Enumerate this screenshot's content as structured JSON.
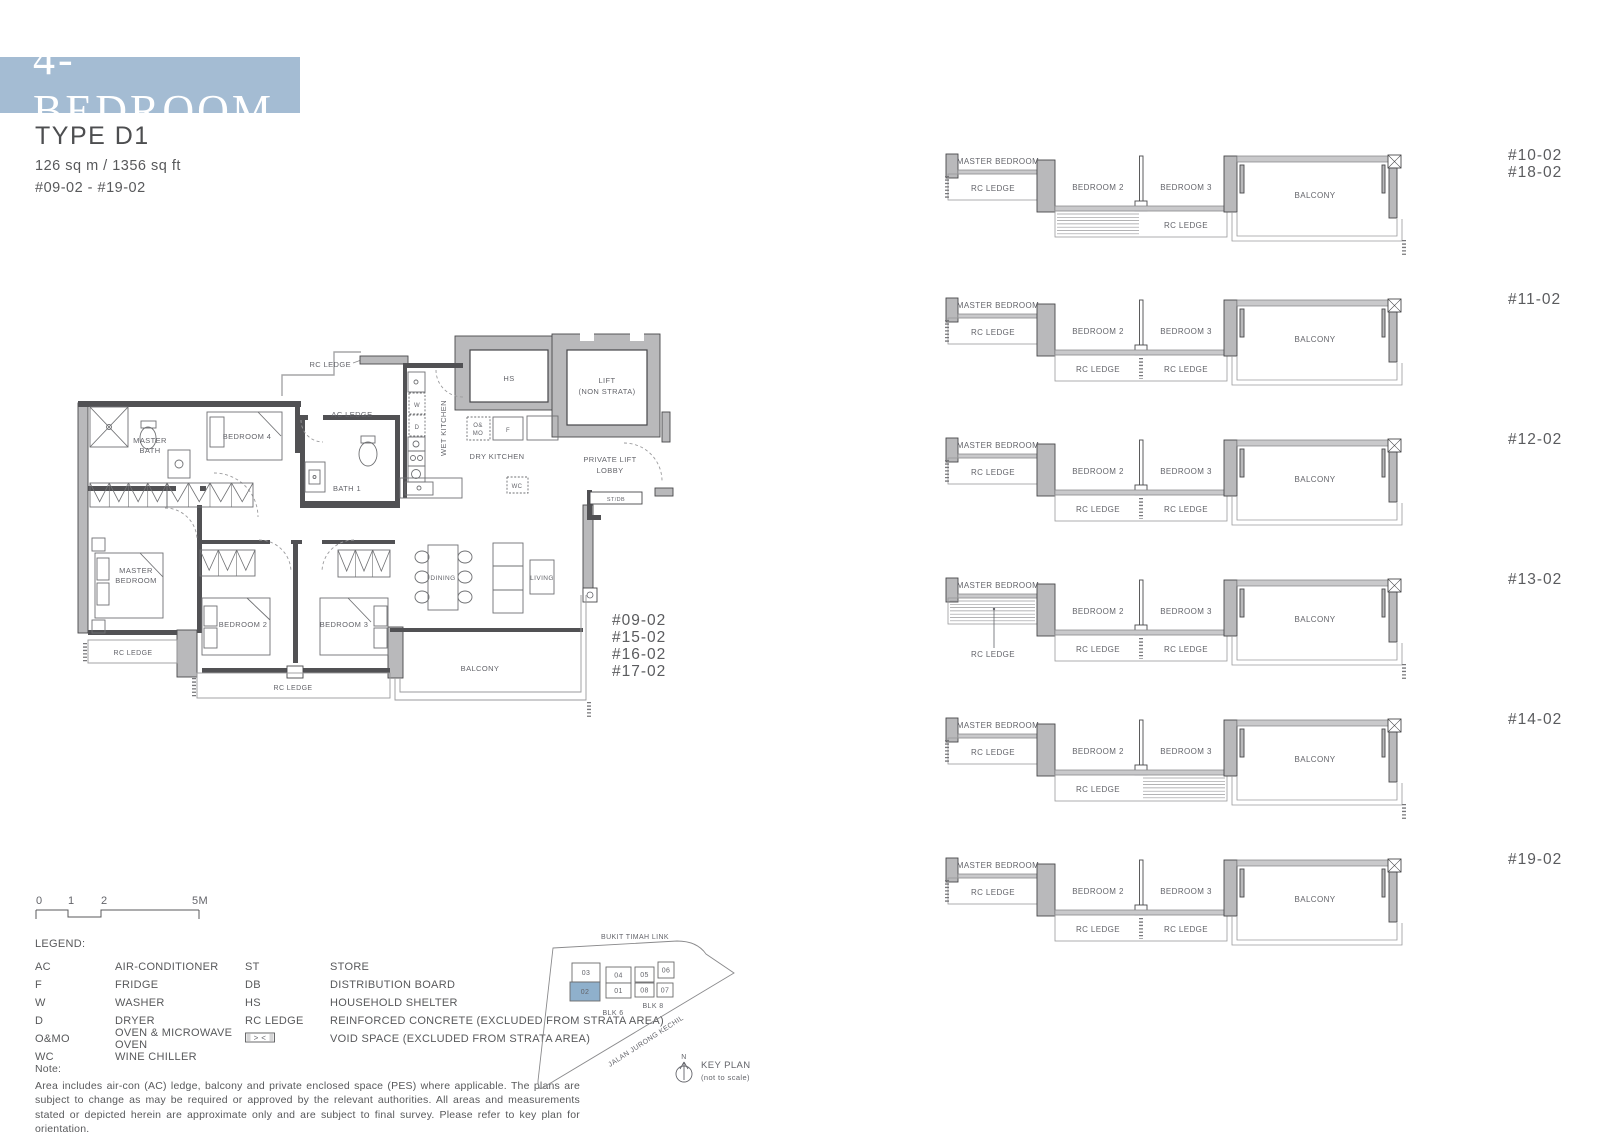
{
  "header": {
    "banner": "4-BEDROOM",
    "type_label": "TYPE D1",
    "area": "126 sq m / 1356 sq ft",
    "unit_range": "#09-02 - #19-02",
    "accent_color": "#a4bcd3"
  },
  "floorplan": {
    "unit_stack": [
      "#09-02",
      "#15-02",
      "#16-02",
      "#17-02"
    ],
    "labels": [
      {
        "id": "rc-ledge-top",
        "t": "RC LEDGE",
        "x": 286,
        "y": 37,
        "s": 7.5,
        "a": "end"
      },
      {
        "id": "ac-ledge",
        "t": "AC LEDGE",
        "x": 287,
        "y": 87,
        "s": 7.5
      },
      {
        "id": "hs",
        "t": "HS",
        "x": 444,
        "y": 51,
        "s": 7.5
      },
      {
        "id": "lift-1",
        "t": "LIFT",
        "x": 542,
        "y": 53,
        "s": 7.5
      },
      {
        "id": "lift-2",
        "t": "(NON STRATA)",
        "x": 542,
        "y": 64,
        "s": 7.5
      },
      {
        "id": "wet-kitchen",
        "t": "WET KITCHEN",
        "x": 381,
        "y": 98,
        "s": 7.5,
        "rot": -90
      },
      {
        "id": "dry-kitchen",
        "t": "DRY KITCHEN",
        "x": 432,
        "y": 129,
        "s": 7.5
      },
      {
        "id": "private-lift-lobby-1",
        "t": "PRIVATE LIFT",
        "x": 545,
        "y": 132,
        "s": 7.5
      },
      {
        "id": "private-lift-lobby-2",
        "t": "LOBBY",
        "x": 545,
        "y": 143,
        "s": 7.5
      },
      {
        "id": "st-db",
        "t": "ST/DB",
        "x": 551,
        "y": 171,
        "s": 5.5
      },
      {
        "id": "master-bath-1",
        "t": "MASTER",
        "x": 85,
        "y": 113,
        "s": 7.5
      },
      {
        "id": "master-bath-2",
        "t": "BATH",
        "x": 85,
        "y": 123,
        "s": 7.5
      },
      {
        "id": "bedroom-4",
        "t": "BEDROOM 4",
        "x": 182,
        "y": 109,
        "s": 7.5
      },
      {
        "id": "bath-1",
        "t": "BATH 1",
        "x": 282,
        "y": 161,
        "s": 7.5
      },
      {
        "id": "washer",
        "t": "W",
        "x": 352,
        "y": 77,
        "s": 6
      },
      {
        "id": "dryer",
        "t": "D",
        "x": 352,
        "y": 99,
        "s": 6
      },
      {
        "id": "oven-1",
        "t": "O&",
        "x": 413,
        "y": 97,
        "s": 6
      },
      {
        "id": "oven-2",
        "t": "MO",
        "x": 413,
        "y": 105,
        "s": 6
      },
      {
        "id": "fridge",
        "t": "F",
        "x": 443,
        "y": 102,
        "s": 6
      },
      {
        "id": "wine-chiller",
        "t": "WC",
        "x": 452,
        "y": 158,
        "s": 6
      },
      {
        "id": "master-bedroom-1",
        "t": "MASTER",
        "x": 71,
        "y": 243,
        "s": 7.5
      },
      {
        "id": "master-bedroom-2",
        "t": "BEDROOM",
        "x": 71,
        "y": 253,
        "s": 7.5
      },
      {
        "id": "bedroom-2",
        "t": "BEDROOM 2",
        "x": 178,
        "y": 297,
        "s": 7.5
      },
      {
        "id": "bedroom-3",
        "t": "BEDROOM 3",
        "x": 279,
        "y": 297,
        "s": 7.5
      },
      {
        "id": "dining",
        "t": "DINING",
        "x": 378,
        "y": 250,
        "s": 6.5
      },
      {
        "id": "living",
        "t": "LIVING",
        "x": 477,
        "y": 250,
        "s": 6.5
      },
      {
        "id": "balcony",
        "t": "BALCONY",
        "x": 415,
        "y": 341,
        "s": 7.5
      },
      {
        "id": "rc-ledge-left",
        "t": "RC LEDGE",
        "x": 68,
        "y": 325,
        "s": 7
      },
      {
        "id": "rc-ledge-mid",
        "t": "RC LEDGE",
        "x": 228,
        "y": 360,
        "s": 7
      }
    ]
  },
  "strips": {
    "shared": {
      "master": "MASTER BEDROOM",
      "rc": "RC LEDGE",
      "bedroom2": "BEDROOM 2",
      "bedroom3": "BEDROOM 3",
      "balcony": "BALCONY"
    },
    "rows": [
      {
        "units": [
          "#10-02",
          "#18-02"
        ],
        "ledge2_labels": [
          "right"
        ],
        "hatch": "bedroom2",
        "bottom_ticks": true,
        "left_ticks": true
      },
      {
        "units": [
          "#11-02"
        ],
        "ledge2_labels": [
          "left",
          "right"
        ],
        "hatch": null,
        "bottom_ticks": false,
        "left_ticks": true
      },
      {
        "units": [
          "#12-02"
        ],
        "ledge2_labels": [
          "left",
          "right"
        ],
        "hatch": null,
        "bottom_ticks": false,
        "left_ticks": true
      },
      {
        "units": [
          "#13-02"
        ],
        "ledge2_labels": [
          "left",
          "right"
        ],
        "hatch": "master",
        "bottom_ticks": true,
        "left_ticks": false
      },
      {
        "units": [
          "#14-02"
        ],
        "ledge2_labels": [
          "left"
        ],
        "hatch": "bedroom3",
        "bottom_ticks": true,
        "left_ticks": true
      },
      {
        "units": [
          "#19-02"
        ],
        "ledge2_labels": [
          "left",
          "right"
        ],
        "hatch": null,
        "bottom_ticks": false,
        "left_ticks": true
      }
    ]
  },
  "scalebar": {
    "ticks": [
      "0",
      "1",
      "2",
      "5M"
    ]
  },
  "legend": {
    "heading": "LEGEND:",
    "col1": [
      {
        "k": "AC",
        "v": "AIR-CONDITIONER"
      },
      {
        "k": "F",
        "v": "FRIDGE"
      },
      {
        "k": "W",
        "v": "WASHER"
      },
      {
        "k": "D",
        "v": "DRYER"
      },
      {
        "k": "O&MO",
        "v": "OVEN & MICROWAVE OVEN"
      },
      {
        "k": "WC",
        "v": "WINE CHILLER"
      }
    ],
    "col2": [
      {
        "k": "ST",
        "v": "STORE"
      },
      {
        "k": "DB",
        "v": "DISTRIBUTION BOARD"
      },
      {
        "k": "HS",
        "v": "HOUSEHOLD SHELTER"
      },
      {
        "k": "RC LEDGE",
        "v": "REINFORCED CONCRETE (EXCLUDED FROM STRATA AREA)"
      },
      {
        "k": null,
        "symbol": "void-space",
        "v": "VOID SPACE (EXCLUDED FROM STRATA AREA)"
      }
    ]
  },
  "note": {
    "heading": "Note:",
    "body": "Area includes air-con (AC) ledge, balcony and private enclosed space (PES) where applicable. The plans are subject to change as may be required or approved by the relevant authorities. All areas and measurements stated or depicted herein are approximate only and are subject to final survey. Please refer to key plan for orientation."
  },
  "keyplan": {
    "road_top": "BUKIT TIMAH LINK",
    "road_bottom": "JALAN JURONG KECHIL",
    "blk_left": "BLK 6",
    "blk_right": "BLK 8",
    "units": [
      "03",
      "04",
      "05",
      "06",
      "02",
      "01",
      "08",
      "07"
    ],
    "highlighted": "02",
    "highlight_color": "#8fb0cc",
    "north": "N",
    "label": "KEY PLAN",
    "sublabel": "(not to scale)"
  }
}
